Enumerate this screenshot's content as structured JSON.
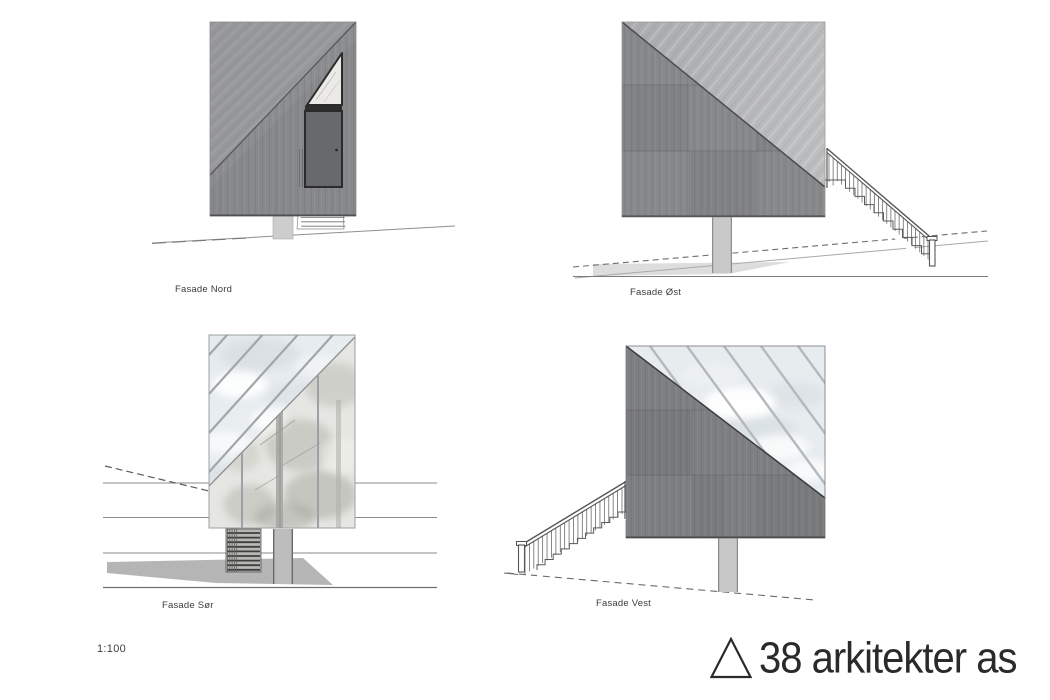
{
  "sheet": {
    "scale_label": "1:100"
  },
  "facades": {
    "nord": {
      "label": "Fasade Nord"
    },
    "ost": {
      "label": "Fasade Øst"
    },
    "sor": {
      "label": "Fasade Sør"
    },
    "vest": {
      "label": "Fasade Vest"
    }
  },
  "logo": {
    "text": "38 arkitekter as",
    "triangle_icon": "triangle-outline"
  },
  "palette": {
    "wall_dark": "#87888a",
    "wall_medium": "#8c8d8f",
    "wall_west": "#7e7f82",
    "roof_light": "#b2b3b5",
    "roof_nord": "#97989a",
    "glass_sky": "#e7ebee",
    "glass_trees": "#e6e6e2",
    "door": "#67696c",
    "column": "#c9c9c9",
    "shadow": "#b5b5b5",
    "terrain_line": "#6a6a6a",
    "label_text": "#3c3c3c",
    "logo_text": "#2a2a2a"
  }
}
